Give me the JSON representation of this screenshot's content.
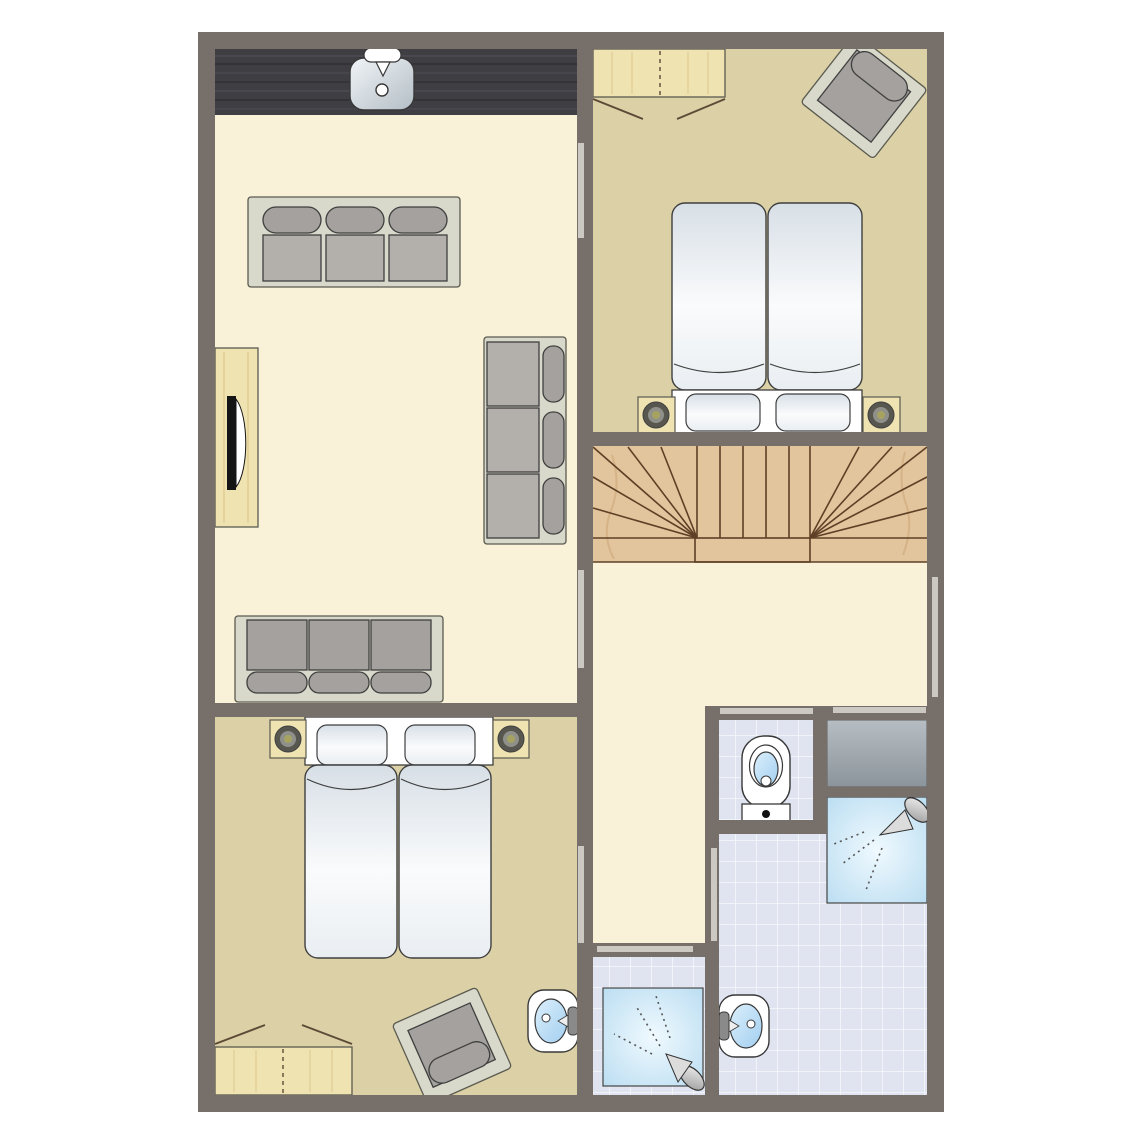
{
  "plan": {
    "type": "floor-plan",
    "rooms": [
      {
        "id": "living-room-kitchen",
        "floor": "cream",
        "features": [
          "kitchen-counter",
          "kitchen-sink",
          "faucet",
          "sofa-3-seat-top",
          "sofa-3-seat-right",
          "sofa-3-seat-bottom",
          "tv-cabinet",
          "tv-screen"
        ]
      },
      {
        "id": "bedroom-top-right",
        "floor": "tan",
        "features": [
          "wardrobe",
          "armchair",
          "double-bed-two-mattresses",
          "two-pillows",
          "nightstand-left-with-lamp",
          "nightstand-right-with-lamp"
        ]
      },
      {
        "id": "staircase",
        "floor": "wood",
        "features": [
          "winder-stairs-double-fan",
          "bottom-landing-step"
        ]
      },
      {
        "id": "hallway-landing",
        "floor": "cream",
        "features": [
          "window-right-wall",
          "door-to-living-room",
          "door-to-bedroom",
          "door-to-bathroom",
          "door-to-shower-room"
        ]
      },
      {
        "id": "bedroom-bottom-left",
        "floor": "tan",
        "features": [
          "double-bed-two-mattresses",
          "two-pillows",
          "nightstand-left-with-lamp",
          "nightstand-right-with-lamp",
          "wardrobe",
          "armchair",
          "washbasin"
        ]
      },
      {
        "id": "bathroom",
        "floor": "tile",
        "features": [
          "wc-toilet",
          "gray-counter-unit",
          "shower-cabin",
          "washbasin"
        ]
      },
      {
        "id": "shower-room-bottom",
        "floor": "tile",
        "features": [
          "shower-cabin"
        ]
      }
    ],
    "door_opening_count": 7,
    "window_count": 1
  },
  "palette": {
    "wall": "#766f6a",
    "floor_cream": "#faf2d8",
    "floor_tan": "#dcd1a6",
    "tile": "#dfe4f0",
    "tile_line": "#ffffff",
    "wood_stairs": "#e2c59d",
    "stair_line": "#5e4026",
    "wood_light": "#f0e3b2",
    "wood_grain": "#ddca8d",
    "counter_dark": "#3f3e42",
    "counter_streak_light": "#5a5961",
    "counter_streak_dark": "#2b2a2e",
    "sofa_frame": "#d8d9ca",
    "sofa_cushion": "#a4a19e",
    "sofa_seat": "#b3b0ac",
    "outline_dark": "#3f3f3f",
    "furniture_line": "#5a5a50",
    "door_line": "#5d4b38",
    "fixture_white": "#ffffff",
    "fixture_line": "#383838",
    "mattress_shade": "#d7dfe6",
    "mattress_light": "#fafbfc",
    "mattress_mid": "#e9eef2",
    "basin_light": "#dceffb",
    "basin_deep": "#a2cff0",
    "shower_center": "#eff9fe",
    "shower_edge": "#b8dcf1",
    "gray_counter_light": "#b6bec4",
    "gray_counter_dark": "#8c949b",
    "metal_light": "#f2f2f2",
    "metal_dark": "#9a9a9a",
    "tap_gray": "#8a8a8a",
    "lamp_outer": "#57574f",
    "lamp_mid": "#90908a",
    "lamp_center": "#a6a360",
    "door_bar": "#ccc9c3",
    "spray": "#565656",
    "tv_black": "#151515"
  }
}
